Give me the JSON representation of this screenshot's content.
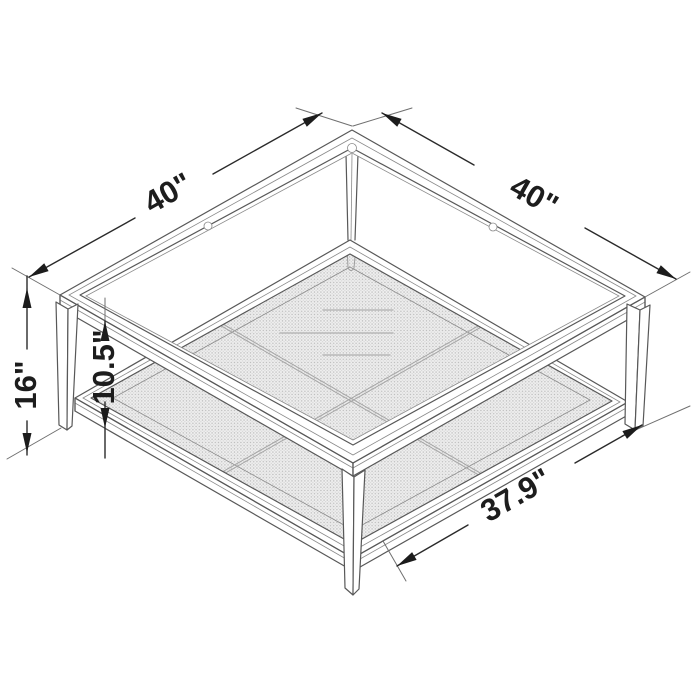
{
  "dimensions": {
    "top_left": {
      "label": "40\""
    },
    "top_right": {
      "label": "40\""
    },
    "height": {
      "label": "16\""
    },
    "clearance": {
      "label": "10.5\""
    },
    "shelf_width": {
      "label": "37.9\""
    }
  },
  "colors": {
    "background": "#ffffff",
    "structure_line": "#585858",
    "dimension_line": "#2a2a2a",
    "label_text": "#1d1d1d",
    "mesh_fill": "#e8e8e8",
    "mesh_dot": "#bdbdbd"
  }
}
